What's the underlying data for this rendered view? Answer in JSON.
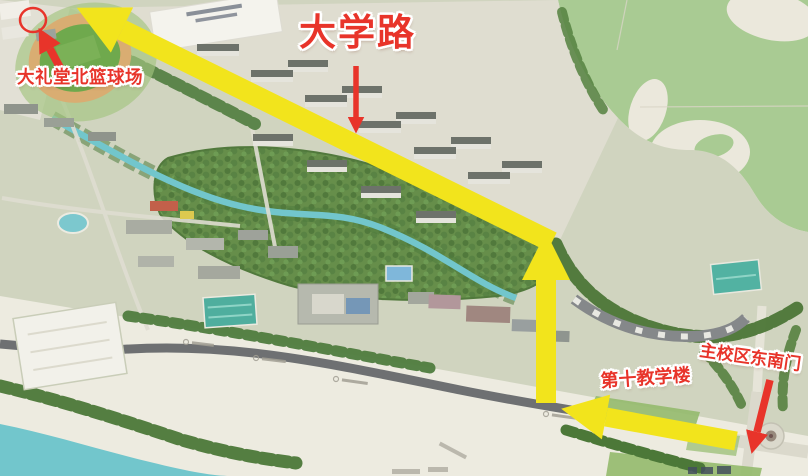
{
  "page": {
    "type": "annotated 3D campus route map",
    "width_px": 808,
    "height_px": 476
  },
  "labels": {
    "road": "大学路",
    "destination": "大礼堂北篮球场",
    "gate": "主校区东南门",
    "teaching_building": "第十教学楼"
  },
  "route": {
    "highlight_color": "#f2e41c",
    "annotation_color": "#e8342a",
    "directions": [
      "west",
      "north",
      "northwest"
    ],
    "start": "主校区东南门",
    "end": "大礼堂北篮球场"
  },
  "colors": {
    "map_beige": "#ebe8dc",
    "park_green": "#a9cb93",
    "campus_ground": "#d0d4bf",
    "water_teal": "#72c6cc",
    "tree_green": "#4c7637",
    "road_dark": "#5f6366"
  }
}
